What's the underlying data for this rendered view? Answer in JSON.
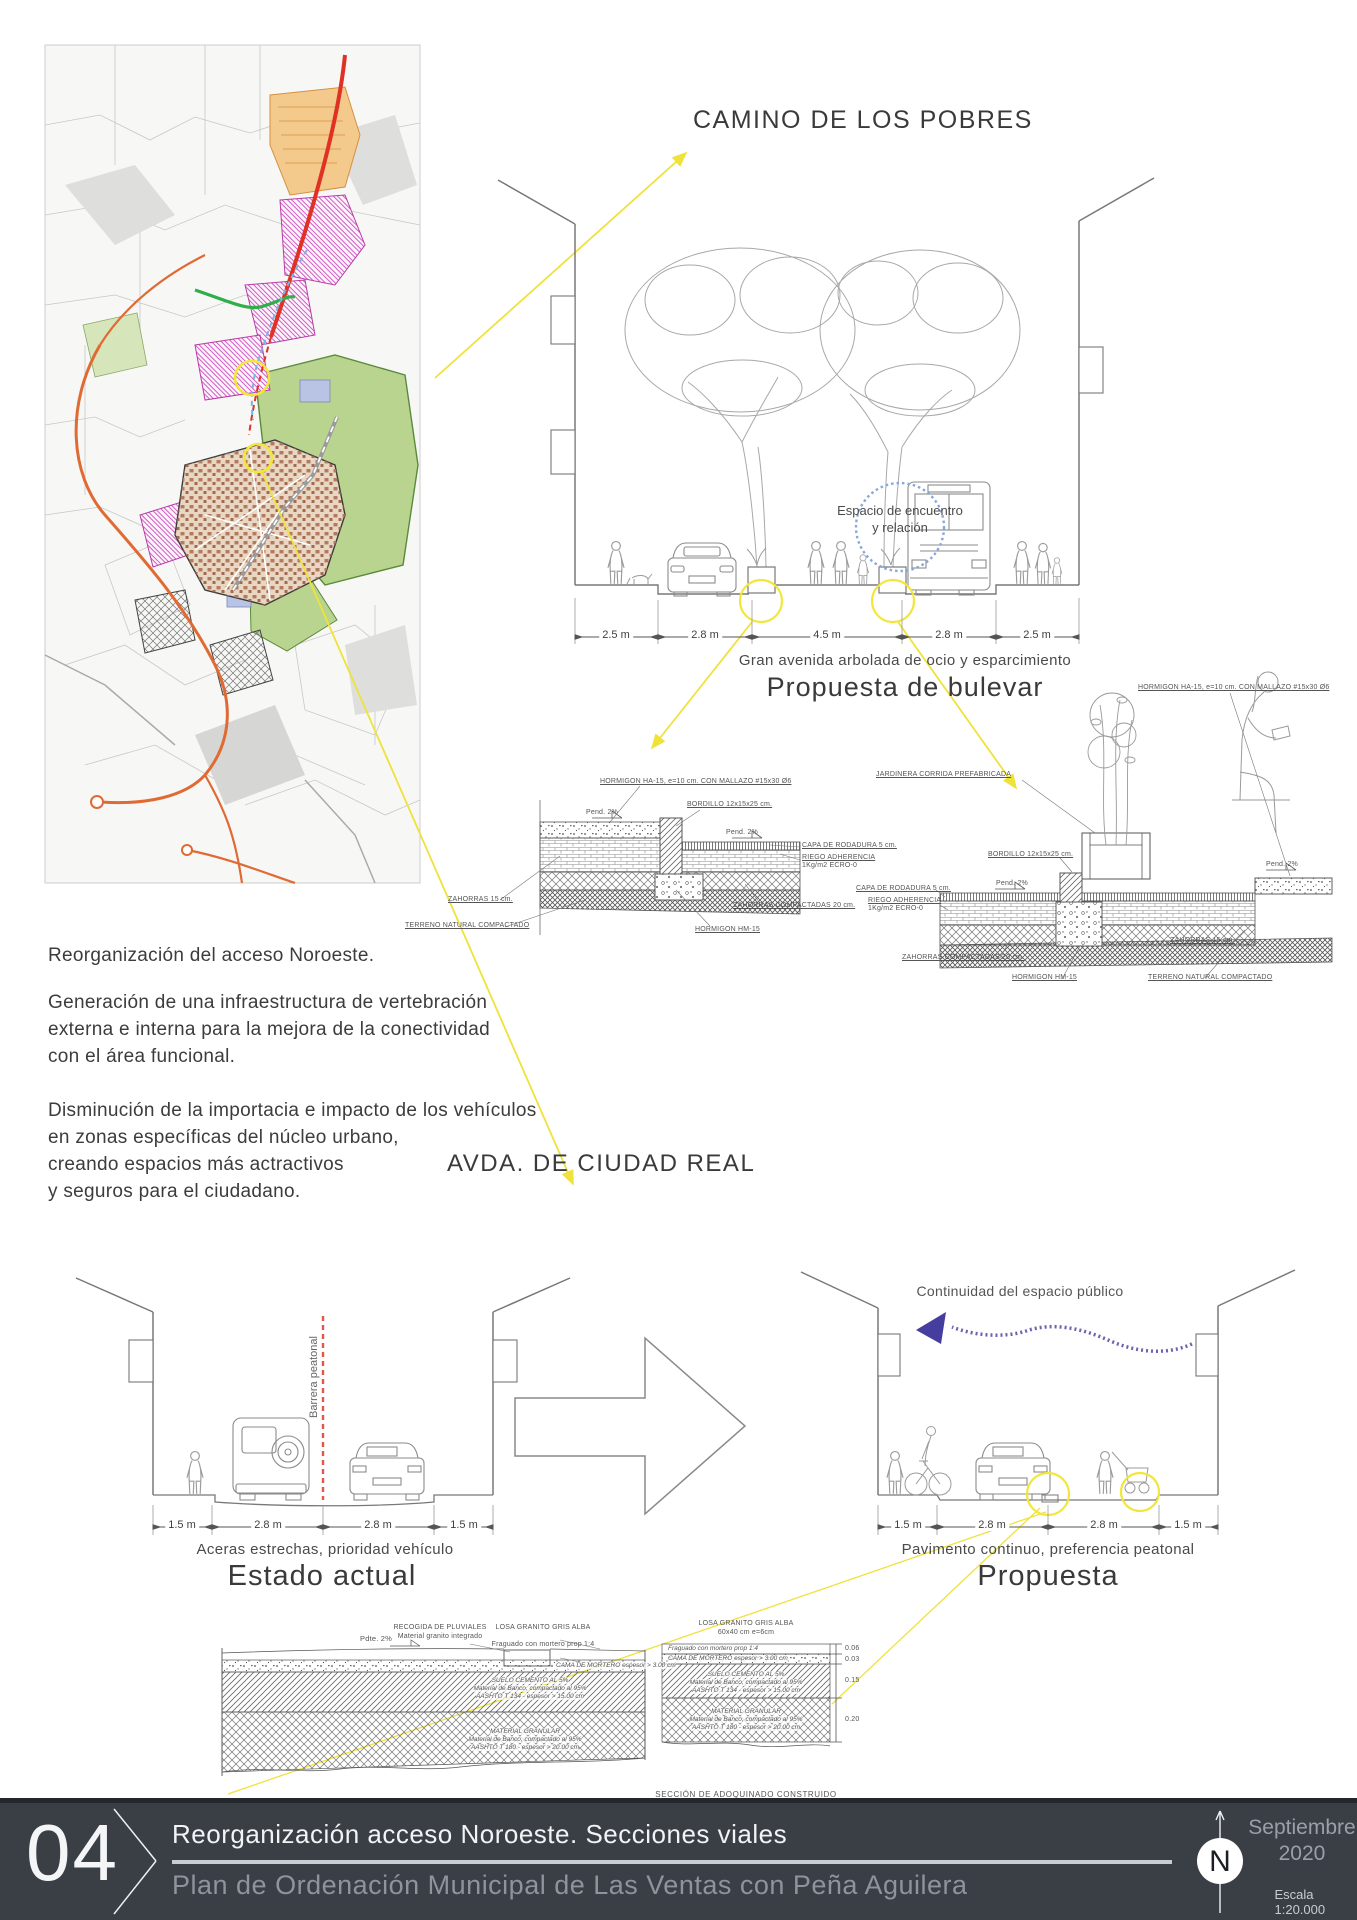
{
  "colors": {
    "accent_yellow": "#f2e63c",
    "barrier_red": "#e2574c",
    "arrow_purple": "#5a53a5",
    "circle_blue": "#86a8d8",
    "footer_bg": "#3a3f46",
    "line_gray": "#8b8b8b",
    "text_dark": "#3d3d3d"
  },
  "camino": {
    "title": "CAMINO DE LOS POBRES",
    "espacio": "Espacio de encuentro\ny relación",
    "dims": [
      "2.5 m",
      "2.8 m",
      "4.5 m",
      "2.8 m",
      "2.5 m"
    ],
    "caption": "Gran avenida arbolada de ocio y esparcimiento",
    "subtitle": "Propuesta de bulevar"
  },
  "pav": {
    "horm_ha": "HORMIGON HA-15, e=10 cm. CON MALLAZO #15x30 Ø6",
    "bordillo": "BORDILLO 12x15x25 cm.",
    "pend": "Pend. 2%",
    "capa": "CAPA DE RODADURA 5 cm.",
    "riego1": "RIEGO ADHERENCIA",
    "riego2": "1Kg/m2 ECRO-0",
    "zahorras": "ZAHORRAS 15 cm.",
    "zah_comp": "ZAHORRAS COMPACTADAS 20 cm.",
    "terreno": "TERRENO NATURAL COMPACTADO",
    "horm_hm": "HORMIGON HM-15",
    "jardinera": "JARDINERA CORRIDA PREFABRICADA"
  },
  "intro": {
    "p1": "Reorganización del acceso Noroeste.",
    "p2": "Generación de una infraestructura de vertebración\nexterna e interna para la mejora de la conectividad\ncon el área funcional.",
    "p3": "Disminución de la importacia e impacto de los vehículos\nen zonas específicas del núcleo urbano,\ncreando espacios más actractivos\ny seguros para el ciudadano."
  },
  "avda": {
    "title": "AVDA. DE CIUDAD REAL"
  },
  "estado": {
    "barrier": "Barrera peatonal",
    "dims": [
      "1.5 m",
      "2.8 m",
      "2.8 m",
      "1.5 m"
    ],
    "caption": "Aceras estrechas, prioridad vehículo",
    "title": "Estado actual"
  },
  "propuesta": {
    "continuity": "Continuidad del espacio público",
    "dims": [
      "1.5 m",
      "2.8 m",
      "2.8 m",
      "1.5 m"
    ],
    "caption": "Pavimento continuo, preferencia peatonal",
    "title": "Propuesta"
  },
  "adoq": {
    "pdte": "Pdte. 2%",
    "recogida1": "RECOGIDA DE PLUVIALES",
    "recogida2": "Material granito integrado",
    "losa1": "LOSA GRANITO GRIS ALBA",
    "losa2": "60x40 cm e=6cm",
    "fraguado": "Fraguado con mortero prop 1:4",
    "cama": "CAMA DE MORTERO espesor > 3.00 cm",
    "suelo1": "SUELO CEMENTO AL 5%",
    "suelo2": "Material de Banco, compactado al 95%",
    "suelo3": "AASHTO  T 134 - espesor > 15.00 cm",
    "gran1": "MATERIAL GRANULAR",
    "gran2": "Material de Banco, compactado al 95%",
    "gran3": "AASHTO  T 180 - espesor > 20.00 cm",
    "d1": "0.06",
    "d2": "0.03",
    "d3": "0.15",
    "d4": "0.20",
    "seccion": "SECCIÓN DE ADOQUINADO CONSTRUIDO"
  },
  "footer": {
    "number": "04",
    "line1": "Reorganización acceso Noroeste. Secciones viales",
    "line2": "Plan de Ordenación Municipal de Las Ventas con Peña Aguilera",
    "month_year": "Septiembre\n2020",
    "compass": "N",
    "scale": "Escala 1:20.000"
  }
}
